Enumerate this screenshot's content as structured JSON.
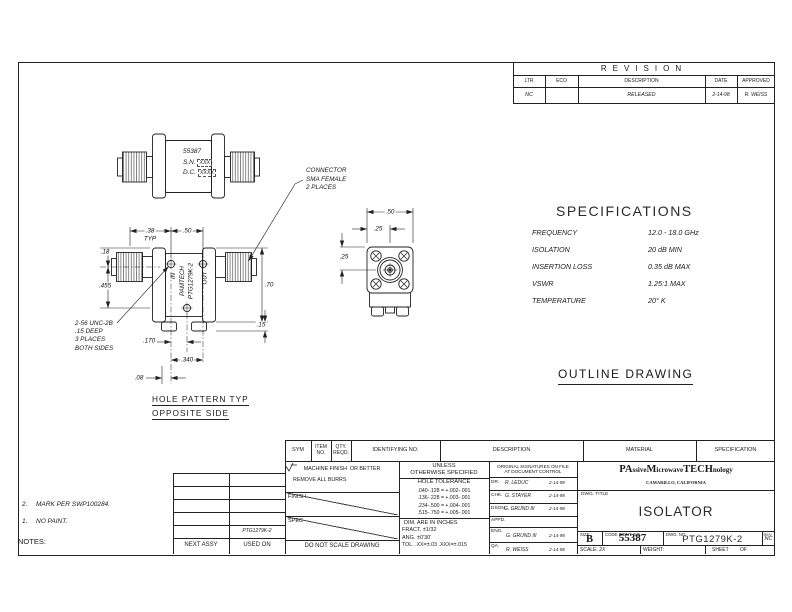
{
  "revision": {
    "title": "REVISION",
    "headers": {
      "ltr": "LTR",
      "eco": "ECO",
      "description": "DESCRIPTION",
      "date": "DATE",
      "approved": "APPROVED"
    },
    "row": {
      "ltr": "NC",
      "eco": "",
      "description": "RELEASED",
      "date": "2-14-98",
      "approved": "R. WEISS"
    }
  },
  "top_view": {
    "part": "55387",
    "sn_label": "S.N.",
    "sn_value": "XXX",
    "dc_label": "D.C.",
    "dc_value": "XXXX",
    "callout": [
      "CONNECTOR",
      "SMA FEMALE",
      "2 PLACES"
    ]
  },
  "front_view": {
    "dims": {
      "d38": ".38",
      "typ": "TYP",
      "d50": ".50",
      "d18": ".18",
      "d455": ".455",
      "d70": ".70",
      "d15": ".15",
      "d170": ".170",
      "d340": ".340",
      "d08": ".08"
    },
    "labels": {
      "in_port": "IN",
      "out_port": "OUT",
      "brand": "PAMTECH",
      "part": "PTG1279K-2"
    },
    "screw_note": [
      "2-56 UNC-2B",
      ".15 DEEP",
      "3 PLACES",
      "BOTH SIDES"
    ],
    "caption": [
      "HOLE PATTERN TYP",
      "OPPOSITE SIDE"
    ]
  },
  "end_view": {
    "dims": {
      "d50": ".50",
      "d25h": ".25",
      "d25v": ".25"
    }
  },
  "specifications": {
    "title": "SPECIFICATIONS",
    "rows": [
      {
        "label": "FREQUENCY",
        "value": "12.0 - 18.0 GHz"
      },
      {
        "label": "ISOLATION",
        "value": "20 dB MIN"
      },
      {
        "label": "INSERTION LOSS",
        "value": "0.35 dB MAX"
      },
      {
        "label": "VSWR",
        "value": "1.25:1 MAX"
      },
      {
        "label": "TEMPERATURE",
        "value": "20° K"
      }
    ]
  },
  "outline_label": "OUTLINE DRAWING",
  "title_block": {
    "headers": {
      "sym": "SYM",
      "item1": "ITEM",
      "item2": "NO.",
      "qty1": "QTY.",
      "qty2": "REQD.",
      "identifying": "IDENTIFYING NO.",
      "description": "DESCRIPTION",
      "material": "MATERIAL",
      "specification": "SPECIFICATION"
    },
    "finish": {
      "machine": "MACHINE FINISH",
      "or_better": "OR BETTER",
      "remove": "REMOVE ALL BURRS",
      "finish": "FINISH",
      "spec": "SPEC",
      "dns": "DO NOT SCALE DRAWING"
    },
    "tolerance": {
      "unless1": "UNLESS",
      "unless2": "OTHERWISE SPECIFIED",
      "hole_title": "HOLE TOLERANCE",
      "rows": [
        ".040-.128  =  +.002-.001",
        ".136-.228  =  +.003-.001",
        ".234-.500  =  +.004-.001",
        ".515-.750  =  +.005-.001"
      ],
      "dims": [
        "DIM. ARE IN INCHES",
        "FRACT. ±1/32",
        "ANG. ±0'30'",
        "TOL. .XX=±.03 .XXX=±.015"
      ]
    },
    "signatures": {
      "header1": "ORIGINAL SIGNATURES ON FILE",
      "header2": "AT DOCUMENT CONTROL",
      "rows": [
        {
          "role": "DR.",
          "name": "R. LEDUC",
          "date": "2-14-98"
        },
        {
          "role": "CHK.",
          "name": "G. STAYER",
          "date": "2-14-98"
        },
        {
          "role": "DSGN.",
          "name": "G. GRUND III",
          "date": "2-14-98"
        },
        {
          "role": "APPD.",
          "name": "",
          "date": ""
        },
        {
          "role": "ENG.",
          "name": "G. GRUND III",
          "date": "2-14-98"
        },
        {
          "role": "QA.",
          "name": "R. WEISS",
          "date": "2-14-98"
        }
      ]
    },
    "company": {
      "p1": "PA",
      "p2": "ssive ",
      "p3": "M",
      "p4": "icrowave ",
      "p5": "TECH",
      "p6": "nology",
      "city": "CAMARILLO, CALIFORNIA"
    },
    "drawing": {
      "title_label": "DWG. TITLE",
      "title": "ISOLATOR",
      "size_label": "SIZE",
      "size": "B",
      "code_label": "CODE IDENT. NO.",
      "code": "55387",
      "dwg_no_label": "DWG. NO.",
      "dwg_no": "PTG1279K-2",
      "rev_label": "REV.",
      "rev": "NC",
      "scale_label": "SCALE:",
      "scale": "2X",
      "weight_label": "WEIGHT:",
      "sheet_label": "SHEET",
      "of_label": "OF"
    }
  },
  "next_assy": {
    "col1": "NEXT ASSY",
    "col2": "USED ON",
    "used_on": "PTG1279K-2"
  },
  "notes": {
    "label": "NOTES:",
    "items": [
      {
        "n": "1.",
        "t": "NO PAINT."
      },
      {
        "n": "2.",
        "t": "MARK PER SWP100284."
      }
    ]
  }
}
